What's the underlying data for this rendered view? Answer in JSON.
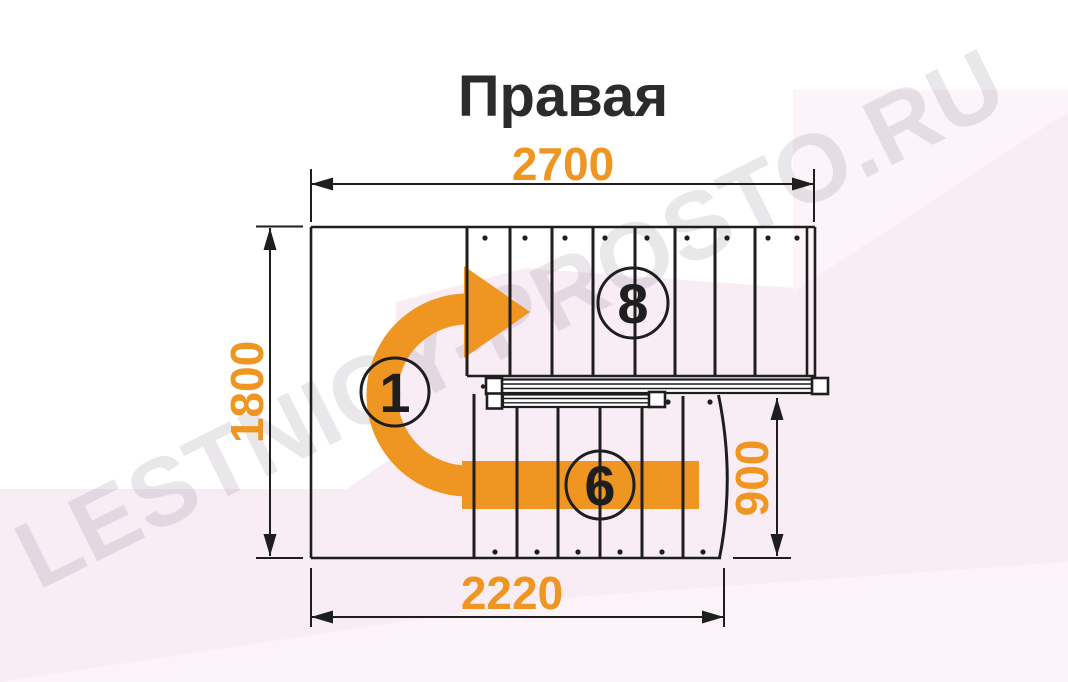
{
  "title": "Правая",
  "watermark": "LESTNICY-PROSTO.RU",
  "dimensions": {
    "top_width_mm": "2700",
    "left_height_mm": "1800",
    "bottom_width_mm": "2220",
    "right_height_mm": "900"
  },
  "step_labels": {
    "first_step": "1",
    "top_flight": "8",
    "bottom_flight": "6"
  },
  "stairs": {
    "type": "U-turn staircase plan, right-hand (clockwise ascent)",
    "top_flight_steps": 8,
    "bottom_flight_steps": 6
  },
  "colors": {
    "accent_orange": "#EF9522",
    "line_black": "#1E1E1E",
    "title_text": "#2B2B2B",
    "pink_background": "#F9EDF5",
    "pink_background_light": "#FCF4F9",
    "watermark_gray": "rgba(85,70,90,0.13)"
  }
}
